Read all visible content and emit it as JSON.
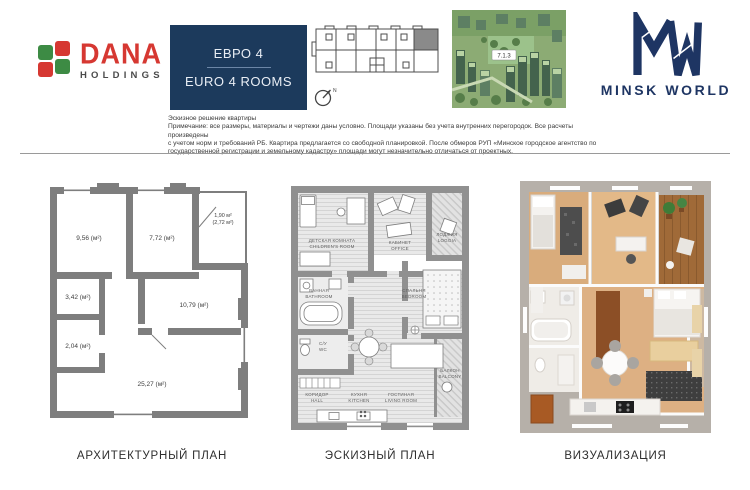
{
  "header": {
    "dana_line1": "DANA",
    "dana_line2": "HOLDINGS",
    "unit_ru": "ЕВРО 4",
    "unit_en": "EURO 4 ROOMS",
    "compass_n": "N",
    "aerial_label": "7.1.3",
    "mw_name": "MINSK WORLD"
  },
  "disclaimer": {
    "line1": "Эскизное решение квартиры",
    "line2": "Примечание: все размеры, материалы и чертежи даны условно. Площади указаны без учета внутренних перегородок. Все расчеты произведены",
    "line3": "с учетом норм и требований РБ. Квартира предлагается со свободной планировкой. После обмеров РУП «Минское городское агентство по",
    "line4": "государственной регистрации и земельному кадастру» площади могут незначительно отличаться от проектных."
  },
  "arch_plan": {
    "room_956": "9,56 (м²)",
    "room_772": "7,72 (м²)",
    "loggia_190": "1,90 м²",
    "loggia_272": "(2,72 м²)",
    "room_342": "3,42 (м²)",
    "room_1079": "10,79 (м²)",
    "room_204": "2,04 (м²)",
    "room_2527": "25,27 (м²)"
  },
  "sketch_plan": {
    "children_ru": "ДЕТСКАЯ КОМНАТА",
    "children_en": "CHILDREN'S ROOM",
    "office_ru": "КАБИНЕТ",
    "office_en": "OFFICE",
    "loggia_ru": "ЛОДЖИЯ",
    "loggia_en": "LOGGIA",
    "bathroom_ru": "ВАННАЯ",
    "bathroom_en": "BATHROOM",
    "wc_ru": "С/У",
    "wc_en": "WC",
    "hall_ru": "КОРИДОР",
    "hall_en": "HALL",
    "kitchen_ru": "КУХНЯ",
    "kitchen_en": "KITCHEN",
    "living_ru": "ГОСТИНАЯ",
    "living_en": "LIVING ROOM",
    "bedroom_ru": "СПАЛЬНЯ",
    "bedroom_en": "BEDROOM",
    "balcony_ru": "БАЛКОН",
    "balcony_en": "BALCONY"
  },
  "captions": {
    "architectural": "АРХИТЕКТУРНЫЙ ПЛАН",
    "sketch": "ЭСКИЗНЫЙ ПЛАН",
    "visualization": "ВИЗУАЛИЗАЦИЯ"
  },
  "colors": {
    "navy": "#1c3a5c",
    "logo_red": "#d63832",
    "logo_green": "#3d8b44",
    "wall_gray": "#7e7e7e",
    "sketch_gray": "#909090",
    "wood_tan": "#ddb083"
  }
}
